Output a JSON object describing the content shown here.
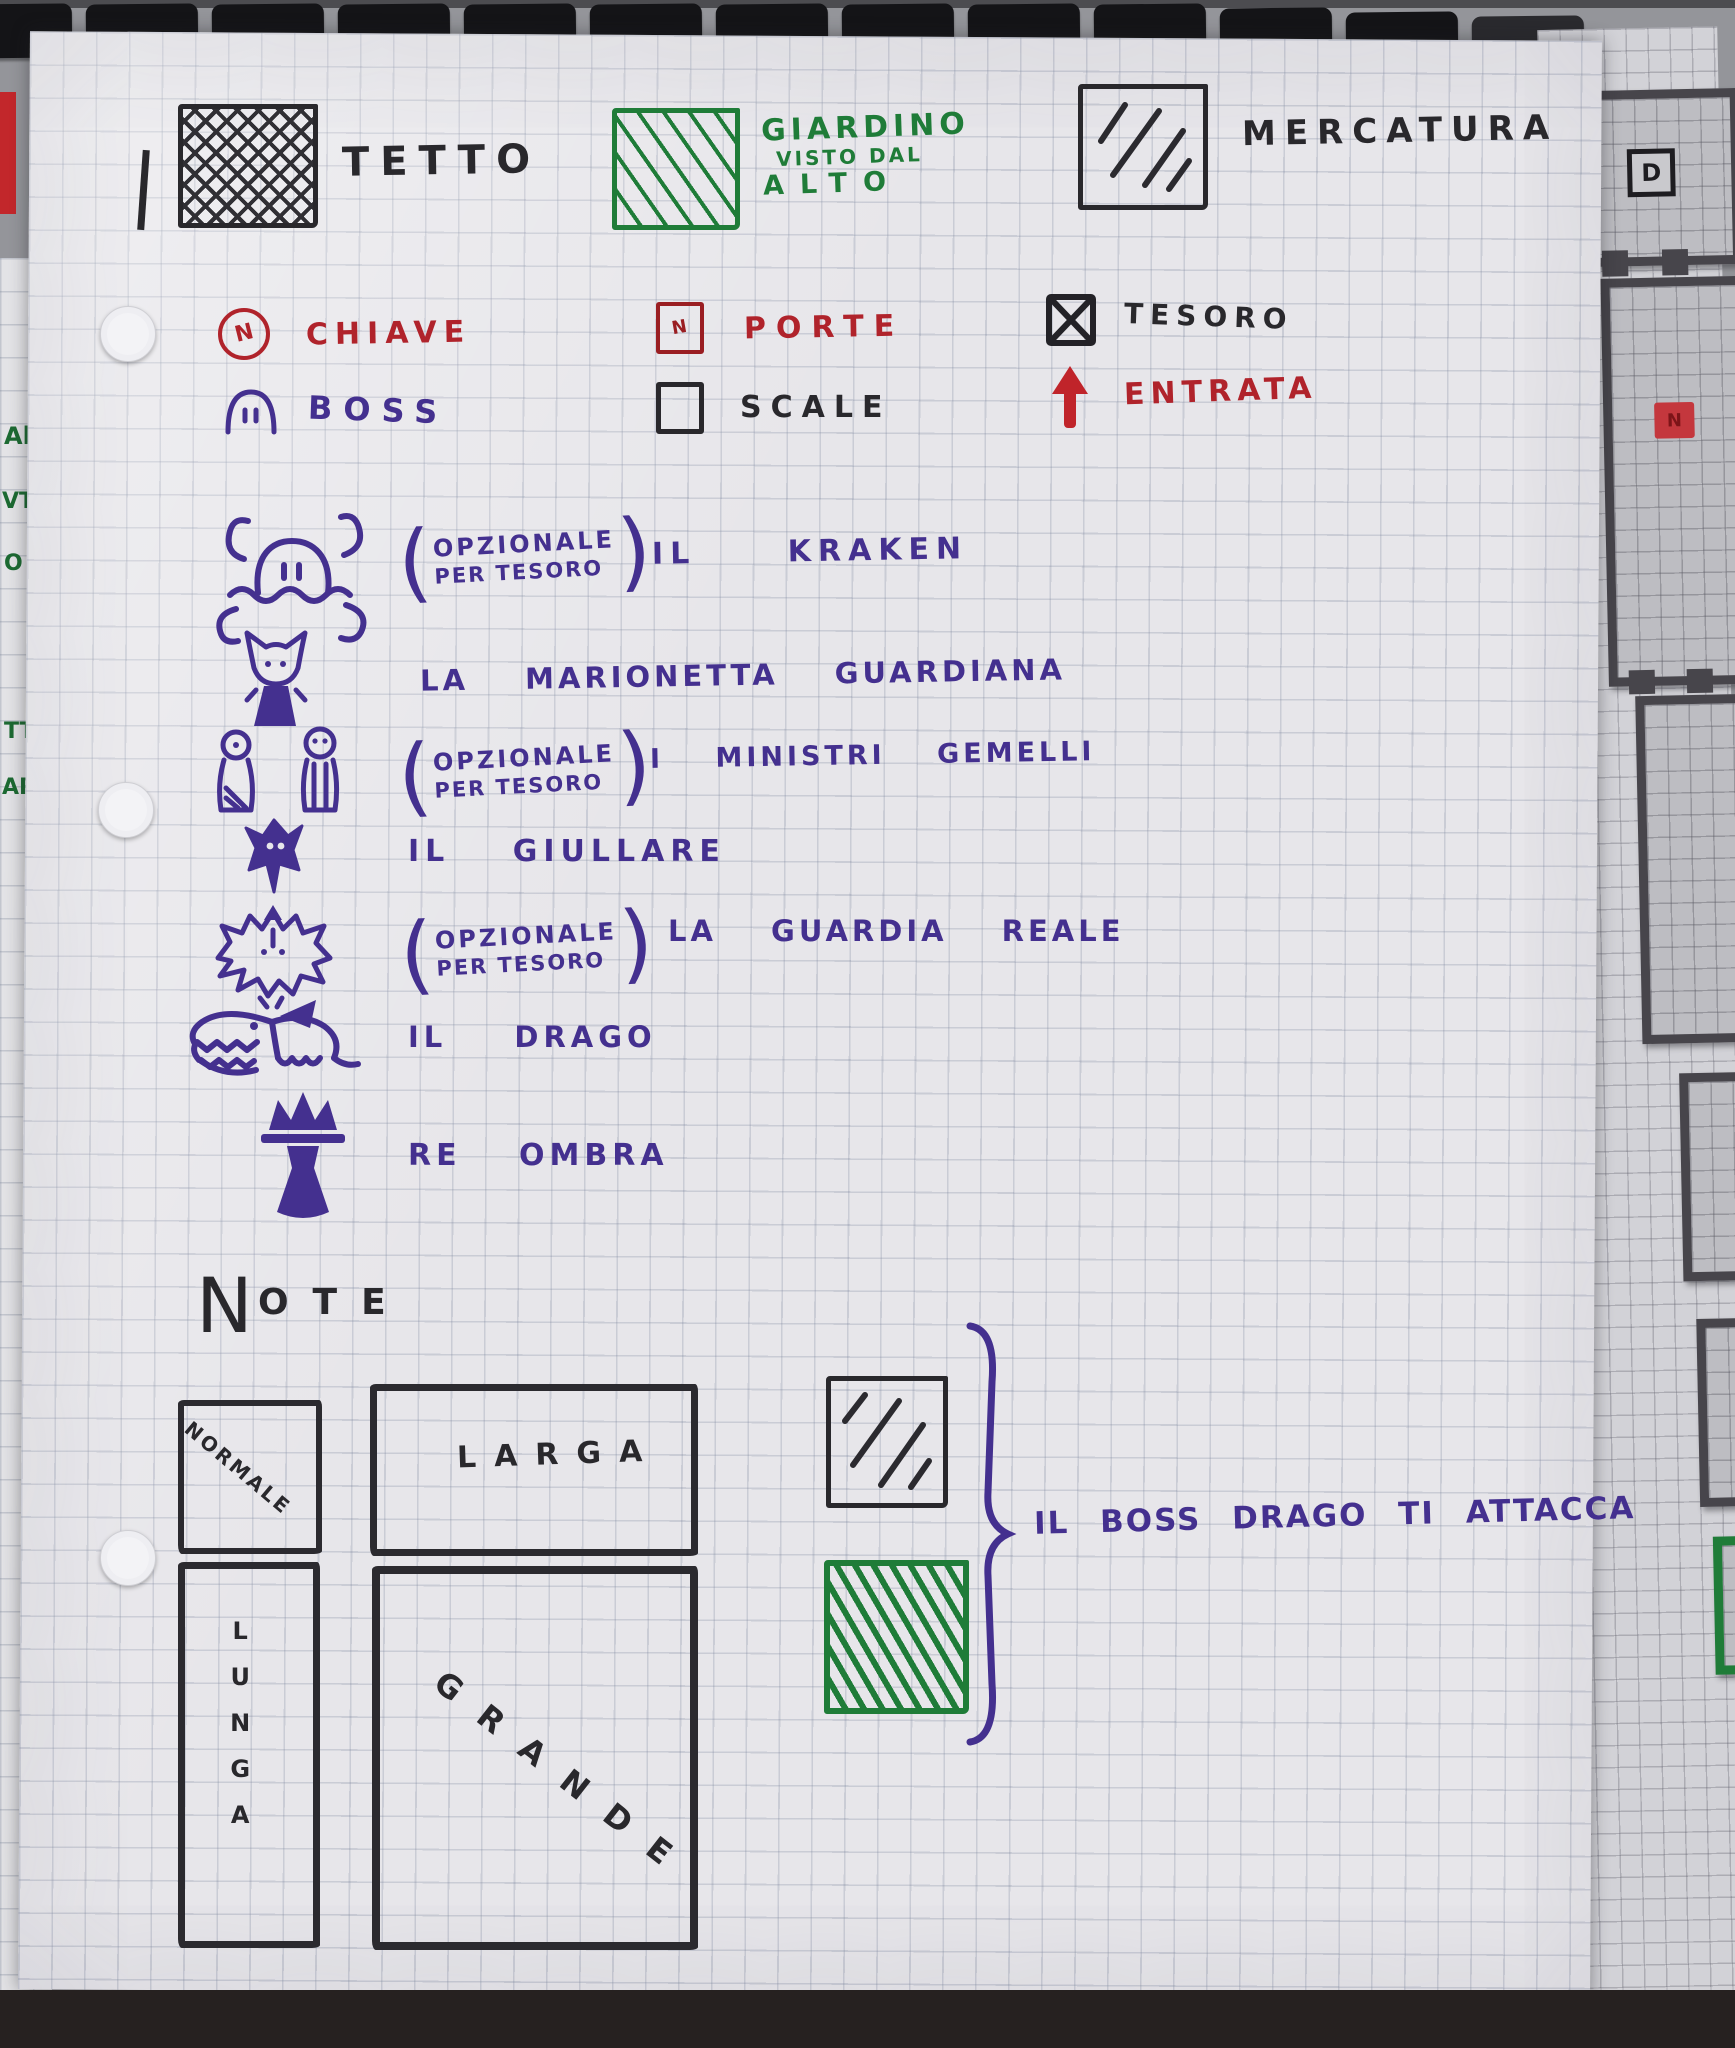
{
  "colors": {
    "red": "#b0232b",
    "darkred": "#9a1e22",
    "green": "#1f7c38",
    "purple": "#44308f",
    "ink": "#29282c"
  },
  "glyphs": {
    "paren_open": "(",
    "paren_close": ")"
  },
  "terrain_legend": {
    "tetto": {
      "label": "TETTO",
      "swatch": "black-crosshatch"
    },
    "giardino": {
      "lines": [
        "GIARDINO",
        "VISTO DAL",
        "ALTO"
      ],
      "swatch": "green-hatch"
    },
    "mercatura": {
      "label": "MERCATURA",
      "swatch": "black-hatch"
    }
  },
  "symbol_legend": {
    "chiave": {
      "label": "CHIAVE",
      "glyph": "N"
    },
    "porte": {
      "label": "PORTE",
      "glyph": "N"
    },
    "tesoro": {
      "label": "TESORO"
    },
    "boss": {
      "label": "BOSS"
    },
    "scale": {
      "label": "SCALE"
    },
    "entrata": {
      "label": "ENTRATA"
    }
  },
  "bestiary": [
    {
      "icon": "kraken",
      "optional_note": [
        "OPZIONALE",
        "PER TESORO"
      ],
      "name": "IL KRAKEN"
    },
    {
      "icon": "guardian-puppet",
      "name": "LA MARIONETTA GUARDIANA"
    },
    {
      "icon": "twin-ministers",
      "optional_note": [
        "OPZIONALE",
        "PER TESORO"
      ],
      "name": "I MINISTRI GEMELLI"
    },
    {
      "icon": "jester",
      "name": "IL GIULLARE"
    },
    {
      "icon": "royal-guard",
      "optional_note": [
        "OPZIONALE",
        "PER TESORO"
      ],
      "name": "LA GUARDIA REALE"
    },
    {
      "icon": "dragon",
      "name": "IL DRAGO"
    },
    {
      "icon": "shadow-king",
      "name": "RE OMBRA"
    }
  ],
  "notes": {
    "heading_initial": "N",
    "heading_rest": "OTE",
    "room_sizes": {
      "normale": "NORMALE",
      "larga": "LARGA",
      "lunga": "LUNGA",
      "grande": "GRANDE"
    },
    "boss_note": "IL BOSS DRAGO TI ATTACCA"
  },
  "surroundings": {
    "left_scraps": [
      "Al",
      "VTI",
      "O",
      "TT",
      "AR"
    ],
    "right_map": {
      "door_label": "D",
      "door_glyph": "N"
    }
  }
}
